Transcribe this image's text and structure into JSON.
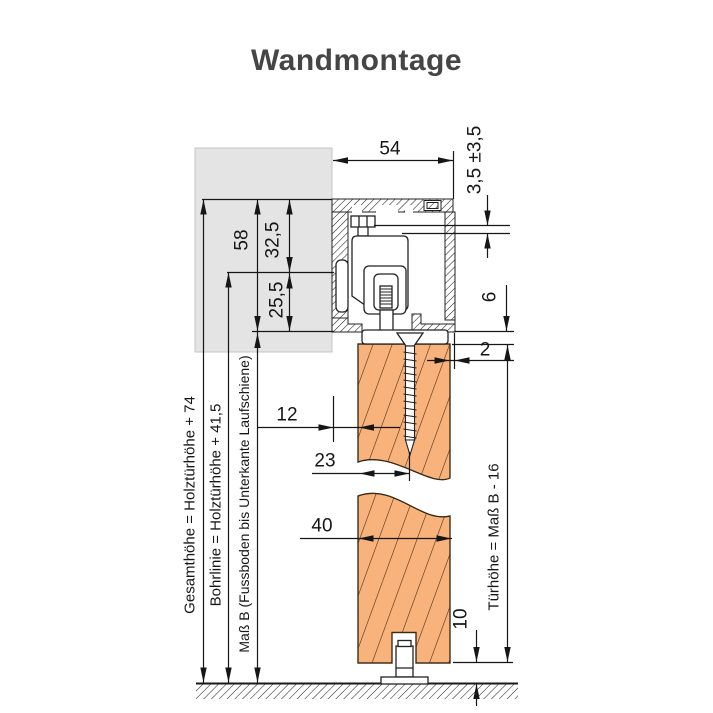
{
  "title": "Wandmontage",
  "dimensions": {
    "track_width": "54",
    "height_adjustment": "3,5 ±3,5",
    "profile_height": "58",
    "upper_section": "32,5",
    "lower_section": "25,5",
    "track_door_gap": "6",
    "wall_door_clearance": "2",
    "wall_to_door_face": "12",
    "door_face_to_screw": "23",
    "door_thickness": "40",
    "floor_clearance": "10"
  },
  "formulas": {
    "gesamthoehe": "Gesamthöhe = Holztürhöhe + 74",
    "bohrlinie": "Bohrlinie = Holztürhöhe + 41,5",
    "mass_b": "Maß B (Fussboden bis Unterkante Laufschiene)",
    "tuerhoehe": "Türhöhe = Maß B - 16"
  },
  "colors": {
    "door_fill": "#f8b27c",
    "door_hatch": "#4a3218",
    "wall_fill": "#e4e4e4",
    "line": "#1a1a1a"
  }
}
